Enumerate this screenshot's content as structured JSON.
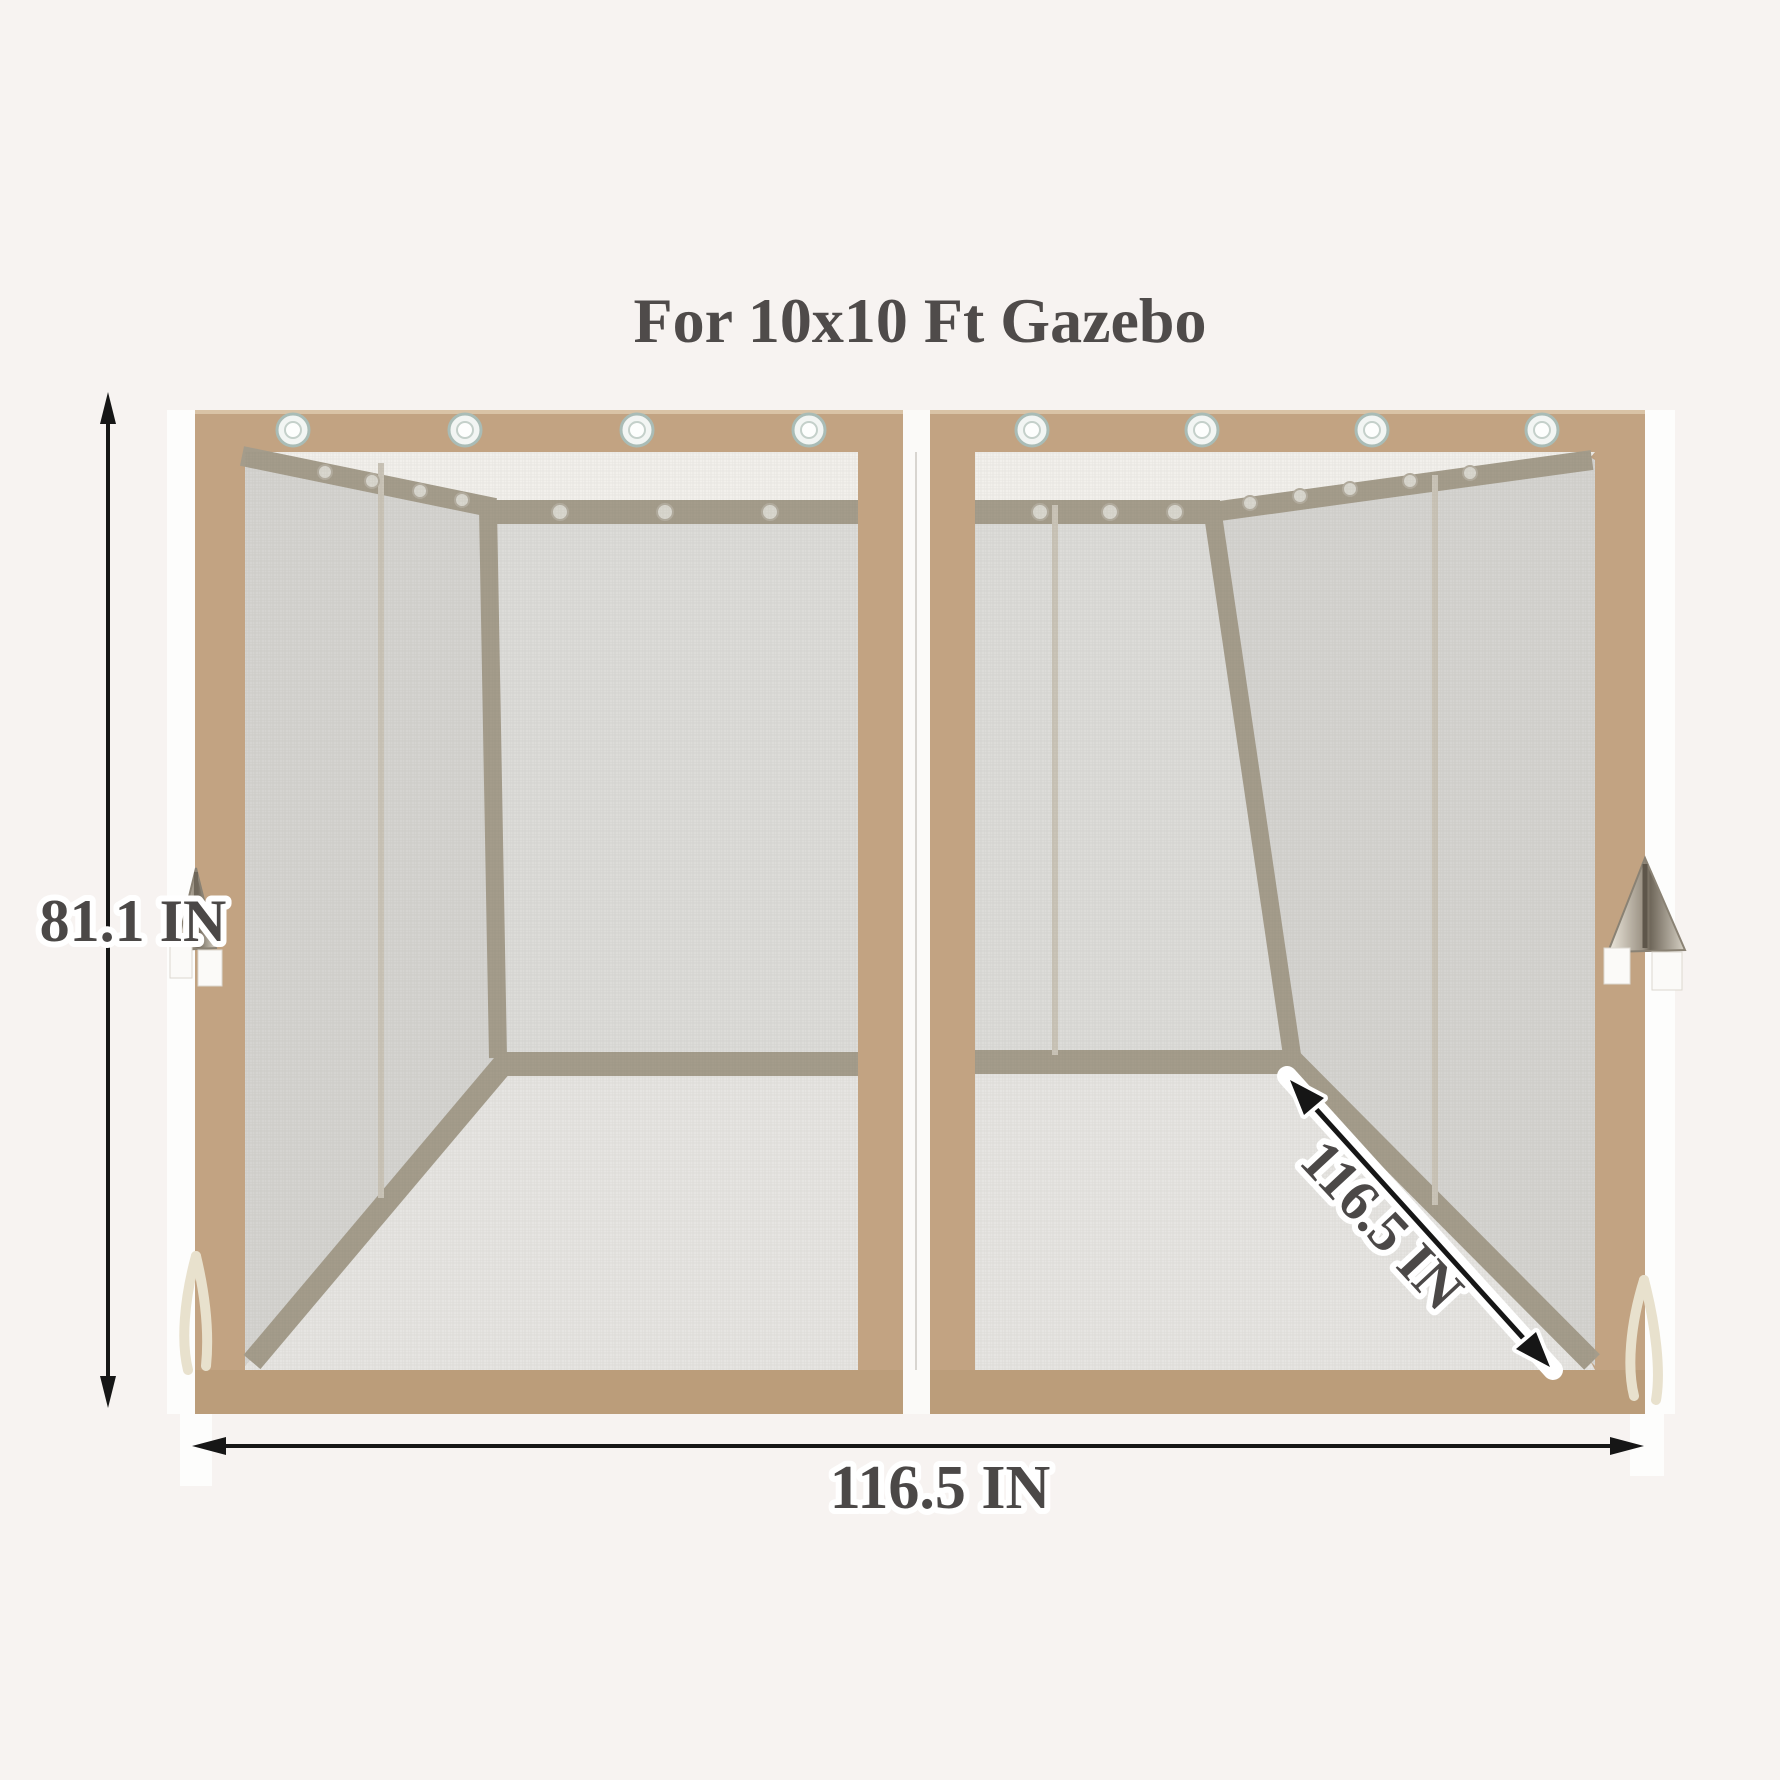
{
  "title": "For 10x10 Ft Gazebo",
  "dimension_labels": {
    "height": "81.1 IN",
    "width_bottom": "116.5 IN",
    "depth_diagonal": "116.5 IN"
  },
  "colors": {
    "background": "#f7f3f1",
    "frame_tan": "#c2a382",
    "frame_tan_bottom": "#bb9d7a",
    "rail_taupe": "#a49c8b",
    "mesh_back_wall": "#dddcd9",
    "mesh_side_wall": "#d5d4d1",
    "mesh_floor": "#e6e5e2",
    "top_strip_white": "#f2f0ec",
    "label_text": "#4b4847",
    "arrow_black": "#161616"
  }
}
